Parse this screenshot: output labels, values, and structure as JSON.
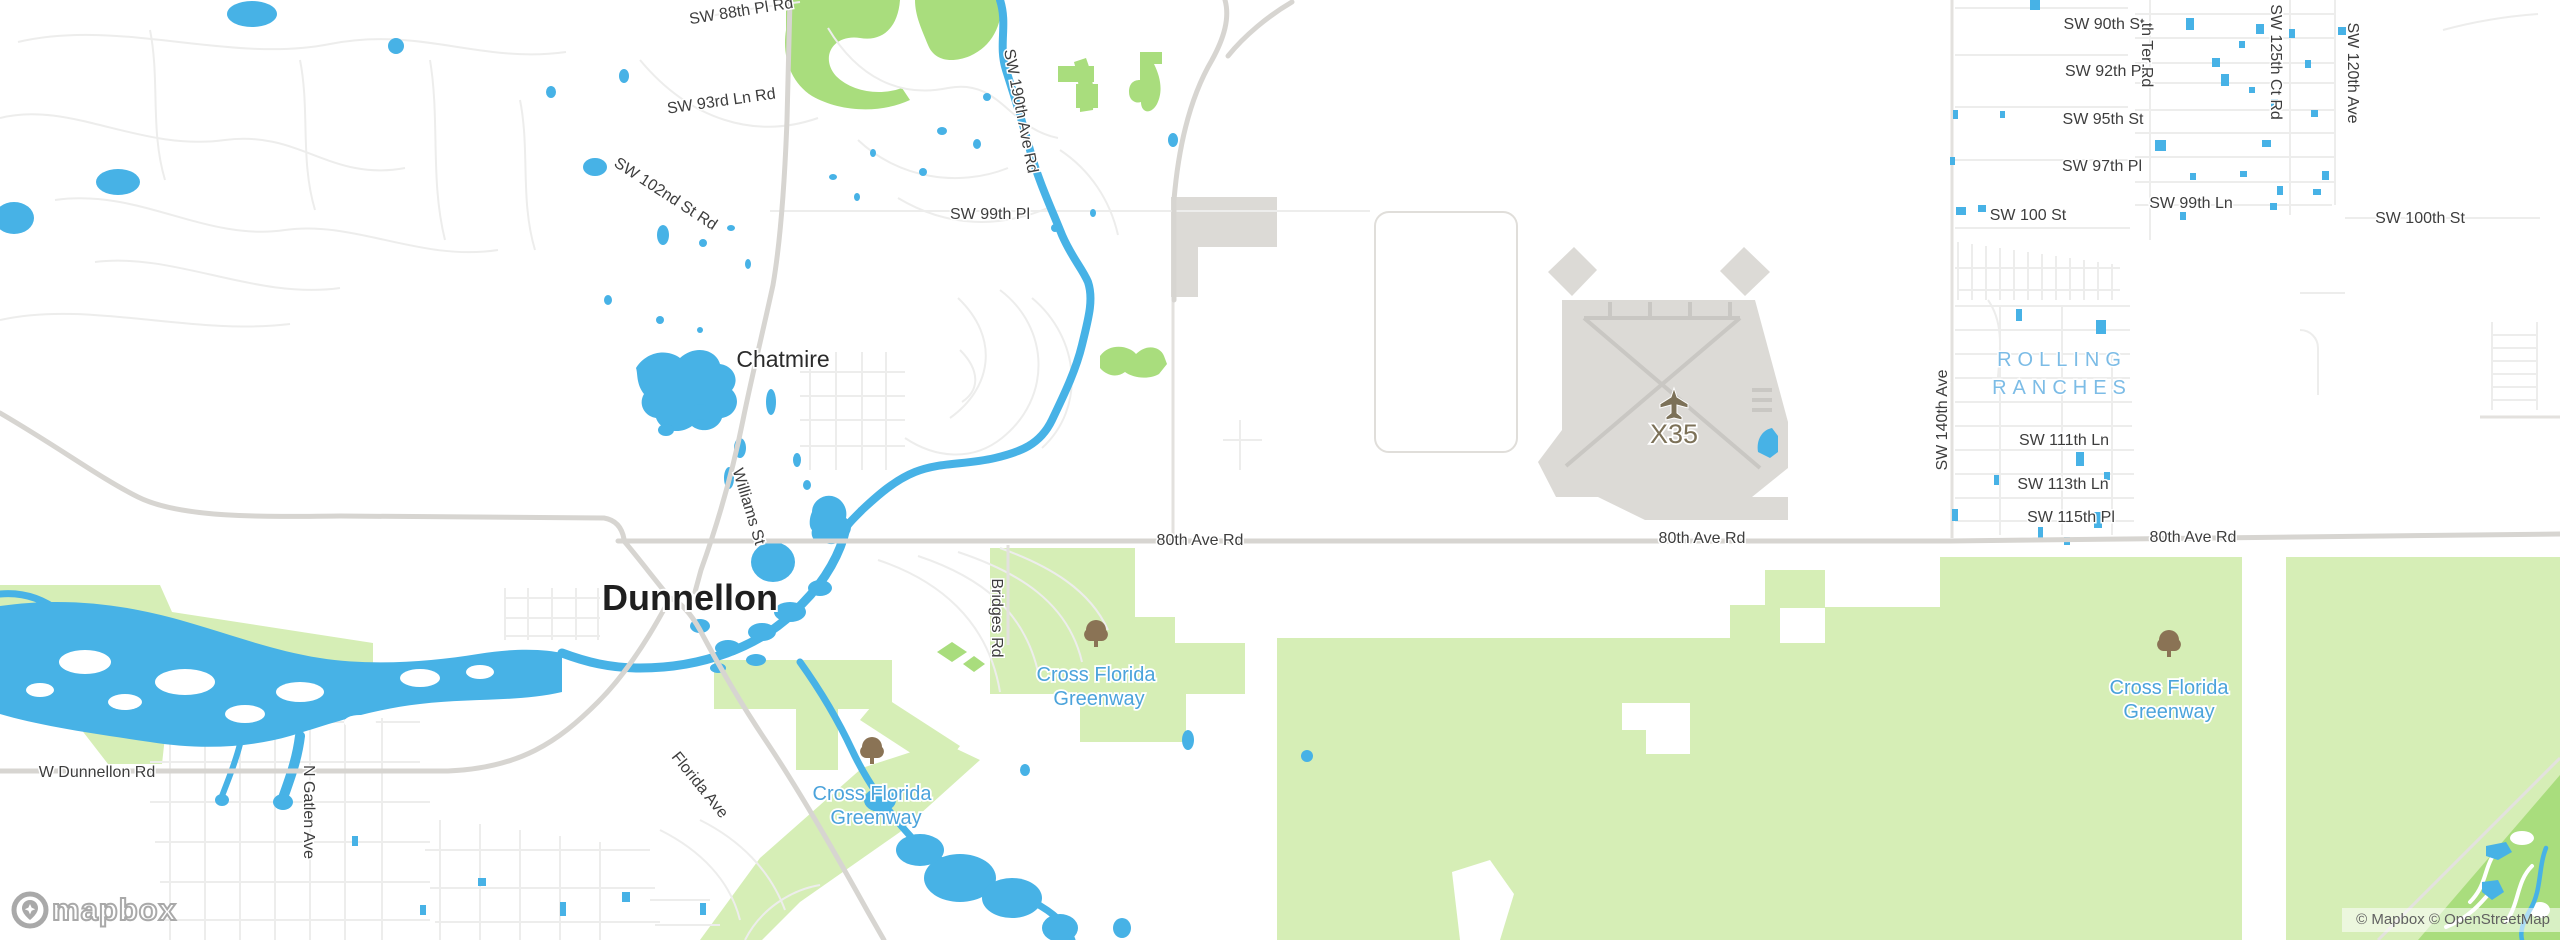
{
  "colors": {
    "water": "#47b2e6",
    "green": "#d6eeb6",
    "golf": "#a9dd7d",
    "building": "#dcdad6",
    "road_main": "#d7d5d1",
    "road_secondary": "#e3e1de",
    "road_minor": "#ededec",
    "runway": "#c9c7c3",
    "label": "#3d3d3d",
    "label_place": "#2b2b2b",
    "label_water": "#4ba3db",
    "label_area": "#7cbce6",
    "label_airport": "#7c7158",
    "icon_tree": "#8a7355",
    "attribution_text": "#606060",
    "logo_gray": "#a9a9a9"
  },
  "labels": {
    "sw_88th_pl_rd": "SW 88th Pl Rd",
    "sw_93rd_ln_rd": "SW 93rd Ln Rd",
    "sw_102nd_st_rd": "SW 102nd St Rd",
    "sw_99th_pl": "SW 99th Pl",
    "sw_190th_ave_rd": "SW 190th Ave Rd",
    "chatmire": "Chatmire",
    "williams_st": "Williams St",
    "dunnellon": "Dunnellon",
    "florida_ave": "Florida Ave",
    "n_gatlen_ave": "N Gatlen Ave",
    "w_dunnellon_rd": "W Dunnellon Rd",
    "bridges_rd": "Bridges Rd",
    "greenway_line1": "Cross Florida",
    "greenway_line2": "Greenway",
    "x35": "X35",
    "rolling_line1": "ROLLING",
    "rolling_line2": "RANCHES",
    "sw_140th_ave": "SW 140th Ave",
    "sw_111th_ln": "SW 111th Ln",
    "sw_113th_ln": "SW 113th Ln",
    "sw_115th_pl": "SW 115th Pl",
    "eightieth_ave_rd": "80th Ave Rd",
    "sw_90th_st": "SW 90th St",
    "sw_92th_pl": "SW 92th Pl",
    "sw_95th_st": "SW 95th St",
    "sw_97th_pl": "SW 97th Pl",
    "sw_100_st": "SW 100 St",
    "sw_99th_ln": "SW 99th Ln",
    "sw_100th_st": "SW 100th St",
    "th_ter_rd": "th Ter Rd",
    "sw_125th_ct_rd": "SW 125th Ct Rd",
    "sw_120th_ave": "SW 120th Ave",
    "attribution": "© Mapbox © OpenStreetMap",
    "logo": "mapbox"
  }
}
